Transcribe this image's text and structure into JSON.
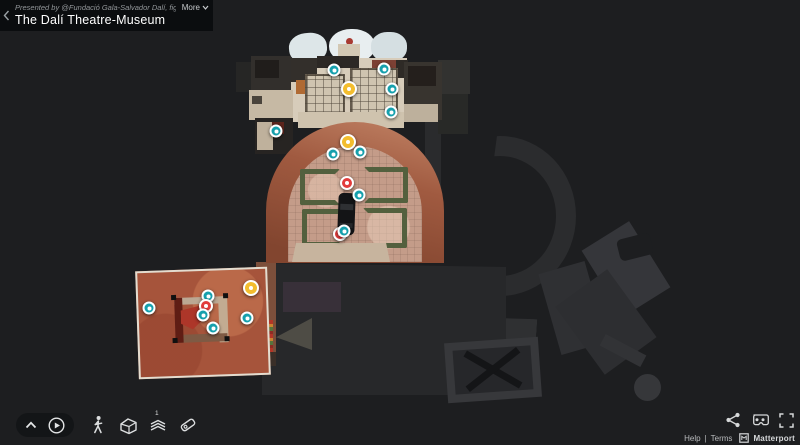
{
  "header": {
    "presented_by": "Presented by @Fundació Gala-Salvador Dalí, figuere...",
    "more_label": "More",
    "title": "The Dalí Theatre-Museum"
  },
  "toolbar": {
    "floor_indicator": "1"
  },
  "footer": {
    "help": "Help",
    "divider": "|",
    "terms": "Terms",
    "brand": "Matterport"
  },
  "icons": {
    "back": "chevron-left-icon",
    "more": "chevron-down-icon",
    "collapse": "chevron-up-icon",
    "play": "play-circle-icon",
    "walk": "walk-mode-icon",
    "dollhouse": "dollhouse-mode-icon",
    "floorplan": "floorplan-mode-icon",
    "measure": "measure-tool-icon",
    "share": "share-icon",
    "vr": "vr-goggles-icon",
    "fullscreen": "fullscreen-icon",
    "brand_logo": "matterport-logo"
  },
  "colors": {
    "background": "#1d1e20",
    "marker_teal": "#16a0ad",
    "marker_yellow": "#f3bd2e",
    "marker_red": "#e23c3c",
    "arch_brick": "#9a5138",
    "courtyard_stone": "#c49c89",
    "hedge_green": "#53603e",
    "room_terracotta": "#a6543b",
    "stage_floor": "#d7ccba"
  },
  "floorplan": {
    "markers": [
      {
        "type": "teal",
        "x": 334,
        "y": 70
      },
      {
        "type": "teal",
        "x": 384,
        "y": 69
      },
      {
        "type": "yellow",
        "x": 349,
        "y": 89
      },
      {
        "type": "teal",
        "x": 392,
        "y": 89
      },
      {
        "type": "teal",
        "x": 391,
        "y": 112
      },
      {
        "type": "teal",
        "x": 276,
        "y": 131
      },
      {
        "type": "yellow",
        "x": 348,
        "y": 142
      },
      {
        "type": "teal",
        "x": 333,
        "y": 154
      },
      {
        "type": "teal",
        "x": 360,
        "y": 152
      },
      {
        "type": "red",
        "x": 347,
        "y": 183
      },
      {
        "type": "teal",
        "x": 359,
        "y": 195
      },
      {
        "type": "red",
        "x": 340,
        "y": 234
      },
      {
        "type": "teal",
        "x": 344,
        "y": 231
      },
      {
        "type": "yellow",
        "x": 251,
        "y": 288
      },
      {
        "type": "teal",
        "x": 208,
        "y": 296
      },
      {
        "type": "red",
        "x": 206,
        "y": 306
      },
      {
        "type": "teal",
        "x": 203,
        "y": 315
      },
      {
        "type": "teal",
        "x": 213,
        "y": 328
      },
      {
        "type": "teal",
        "x": 247,
        "y": 318
      },
      {
        "type": "teal",
        "x": 149,
        "y": 308
      }
    ]
  }
}
